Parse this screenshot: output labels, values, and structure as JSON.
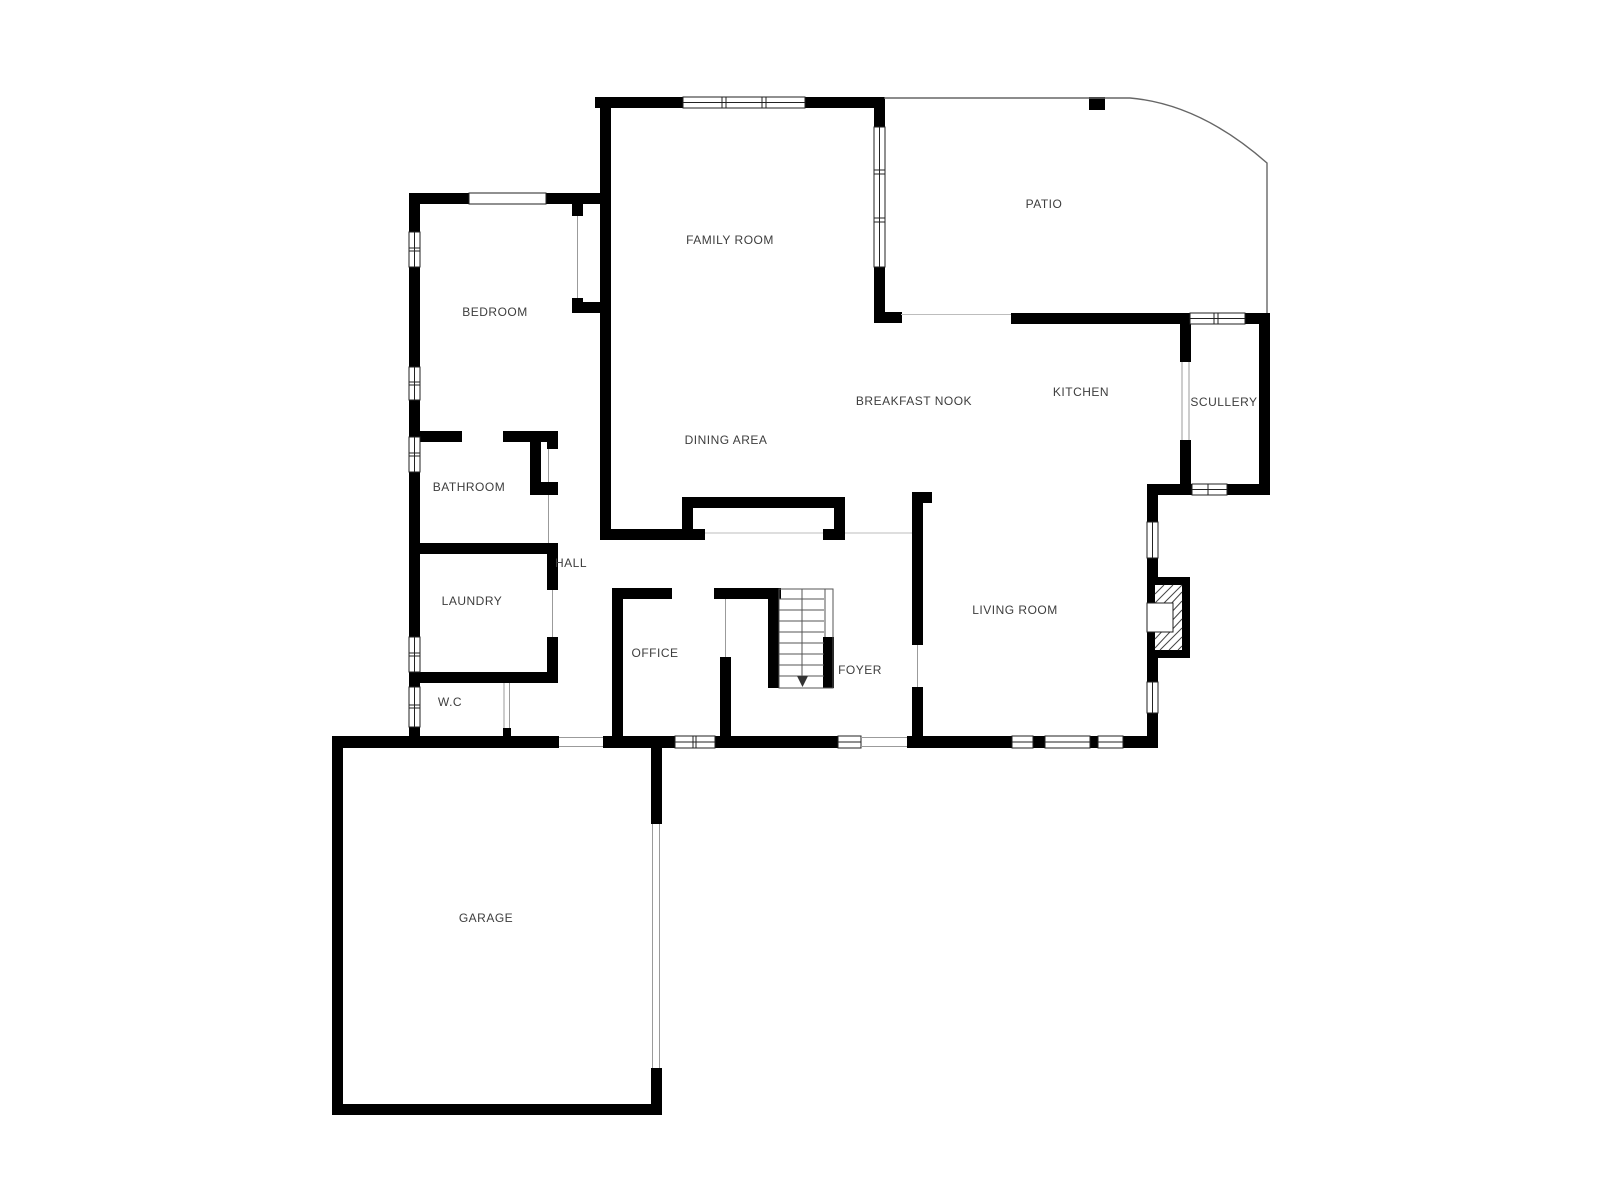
{
  "colors": {
    "background": "#ffffff",
    "wall": "#000000",
    "label": "#3d3d3d"
  },
  "rooms": [
    {
      "id": "family-room",
      "label": "FAMILY ROOM"
    },
    {
      "id": "patio",
      "label": "PATIO"
    },
    {
      "id": "bedroom",
      "label": "BEDROOM"
    },
    {
      "id": "breakfast-nook",
      "label": "BREAKFAST NOOK"
    },
    {
      "id": "kitchen",
      "label": "KITCHEN"
    },
    {
      "id": "scullery",
      "label": "SCULLERY"
    },
    {
      "id": "dining-area",
      "label": "DINING AREA"
    },
    {
      "id": "bathroom",
      "label": "BATHROOM"
    },
    {
      "id": "hall",
      "label": "HALL"
    },
    {
      "id": "laundry",
      "label": "LAUNDRY"
    },
    {
      "id": "office",
      "label": "OFFICE"
    },
    {
      "id": "foyer",
      "label": "FOYER"
    },
    {
      "id": "living-room",
      "label": "LIVING ROOM"
    },
    {
      "id": "wc",
      "label": "W.C"
    },
    {
      "id": "garage",
      "label": "GARAGE"
    }
  ]
}
